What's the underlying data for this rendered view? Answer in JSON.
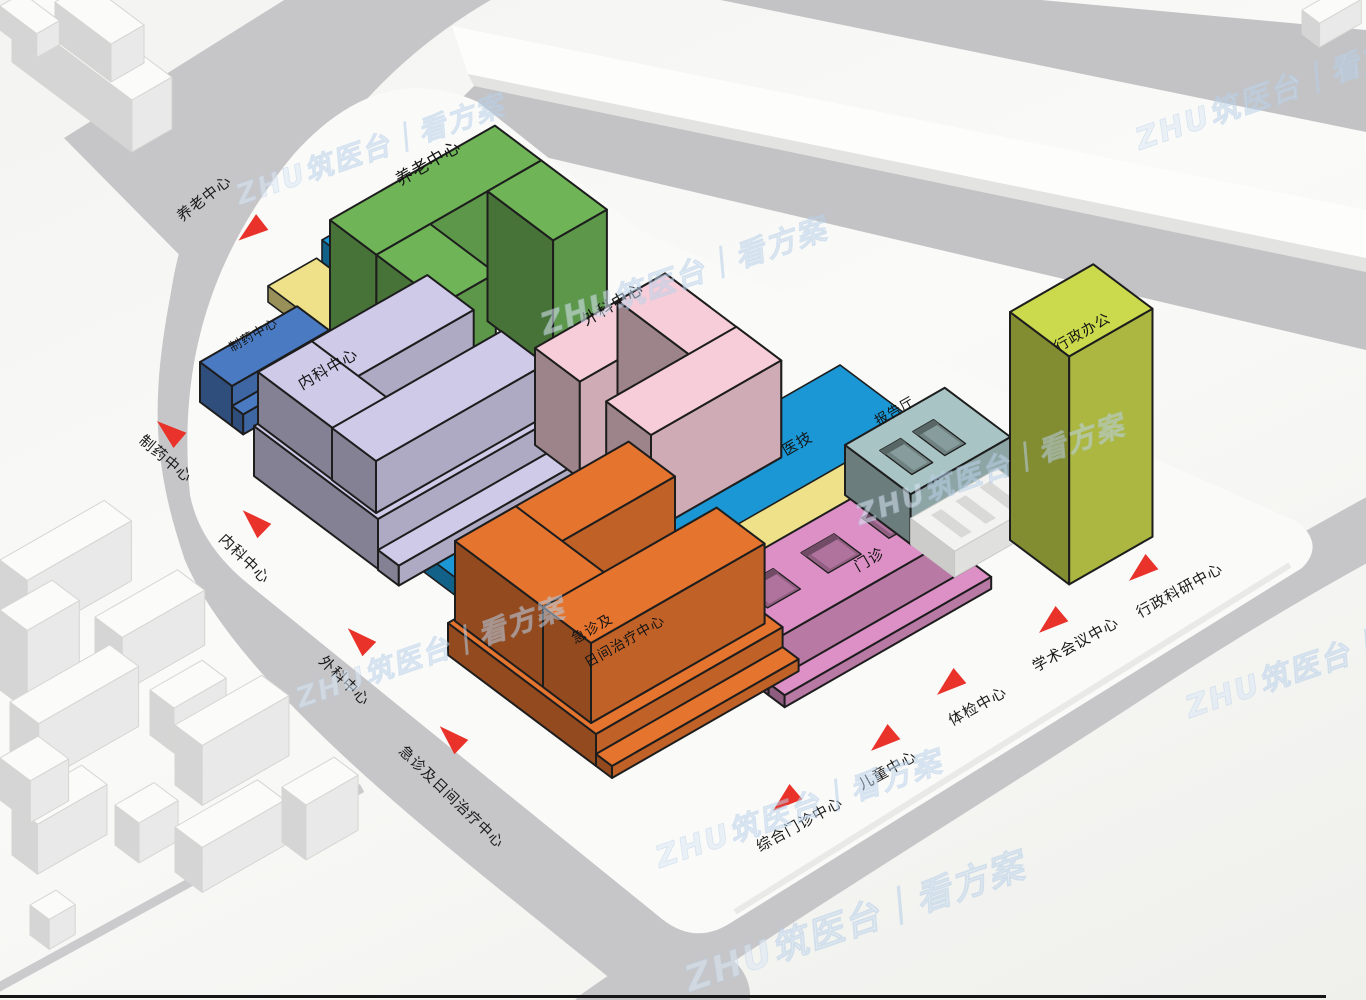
{
  "watermark": {
    "text": "ZHU筑医台｜看方案",
    "color": "#dbe7f4"
  },
  "ground": {
    "plate": "#fafaf9",
    "road": "#c6c6c8",
    "road_strip": "#cbcbcd",
    "band_gray": "#c3c3c5",
    "slab_white": "#fdfdfc",
    "context_building": "#fbfbfa"
  },
  "site": {
    "arrow_color": "#e8322a",
    "street_colors": {
      "yellow": "#eee189",
      "blue": "#1a97d4"
    },
    "buildings": [
      {
        "id": "yanglao",
        "label": "养老中心",
        "color": "#6fb457"
      },
      {
        "id": "zhiyao",
        "label": "制药中心",
        "color": "#4a7ac2"
      },
      {
        "id": "neike",
        "label": "内科中心",
        "color": "#cfcae8"
      },
      {
        "id": "waike",
        "label": "外科中心",
        "color": "#f6cdd8"
      },
      {
        "id": "yiji",
        "label": "医技",
        "color": "#1a97d4"
      },
      {
        "id": "baogaoting",
        "label": "报告厅",
        "color": "#a9c4c4"
      },
      {
        "id": "xingzheng",
        "label": "行政办公",
        "color": "#cbda4d"
      },
      {
        "id": "menzhen",
        "label": "门诊",
        "color": "#dc90c5"
      },
      {
        "id": "jizhen",
        "label": "急诊及日间治疗中心",
        "label_line1": "急诊及",
        "label_line2": "日间治疗中心",
        "color": "#e5742f"
      }
    ],
    "street_labels": [
      {
        "text": "养老中心"
      },
      {
        "text": "制药中心"
      },
      {
        "text": "内科中心"
      },
      {
        "text": "外科中心"
      },
      {
        "text": "急诊及日间治疗中心"
      },
      {
        "text": "综合门诊中心"
      },
      {
        "text": "儿童中心"
      },
      {
        "text": "体检中心"
      },
      {
        "text": "学术会议中心"
      },
      {
        "text": "行政科研中心"
      }
    ]
  }
}
